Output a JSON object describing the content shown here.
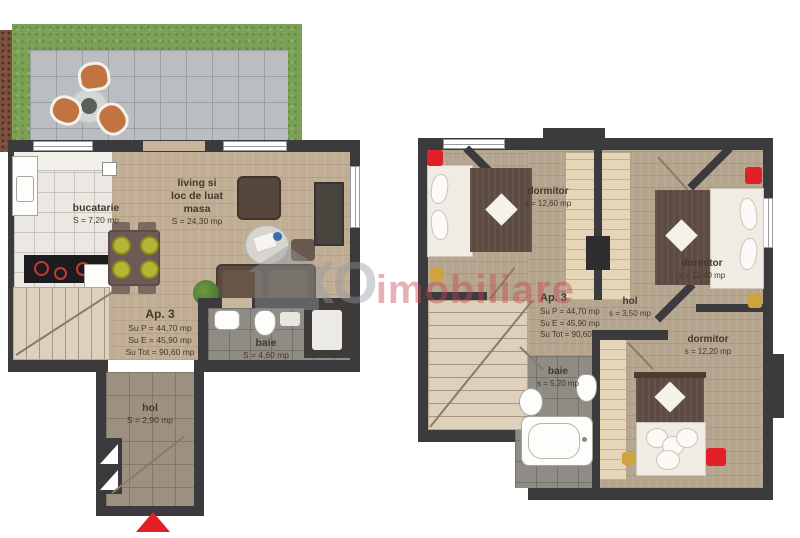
{
  "colors": {
    "wall": "#3b3a3c",
    "wood": "#c0ad94",
    "wood-upper": "#b5a58e",
    "grass": "#7ba156",
    "terrace": "#babec1",
    "tile-kitchen": "#ebe8e3",
    "tile-hall": "#9c9081",
    "tile-bath": "#8f8b85",
    "stairs": "#ddd1bb",
    "blanket": "#5d4b41",
    "mattress": "#f0ece3",
    "accent-red": "#e01f26",
    "gold": "#cda43e",
    "label-ink": "#44382c",
    "watermark-gray": "#939ba1",
    "watermark-red": "#c24750",
    "chair-orange": "#c17440",
    "seat-yellow": "#b8b534"
  },
  "watermark": {
    "brand_gray": "XO",
    "brand_red": "imobiliare"
  },
  "ground_floor": {
    "kitchen": {
      "name": "bucatarie",
      "area": "S = 7,20 mp"
    },
    "living": {
      "line1": "living si",
      "line2": "loc de luat",
      "line3": "masa",
      "area": "S = 24,30 mp"
    },
    "apartment": {
      "title": "Ap. 3",
      "su_p": "Su P = 44,70 mp",
      "su_e": "Su E = 45,90 mp",
      "su_tot": "Su Tot = 90,60 mp"
    },
    "bath": {
      "name": "baie",
      "area": "S = 4,60 mp"
    },
    "hall": {
      "name": "hol",
      "area": "S = 2,90 mp"
    }
  },
  "upper_floor": {
    "bedroom1": {
      "name": "dormitor",
      "area": "s = 12,60 mp"
    },
    "bedroom2": {
      "name": "dormitor",
      "area": "s = 12,40 mp"
    },
    "bedroom3": {
      "name": "dormitor",
      "area": "s = 12,20 mp"
    },
    "apartment": {
      "title": "Ap. 3",
      "su_p": "Su P = 44,70 mp",
      "su_e": "Su E = 45,90 mp",
      "su_tot": "Su Tot = 90,60 mp"
    },
    "hall": {
      "name": "hol",
      "area": "s = 3,50 mp"
    },
    "bath": {
      "name": "baie",
      "area": "s = 5,20 mp"
    }
  }
}
